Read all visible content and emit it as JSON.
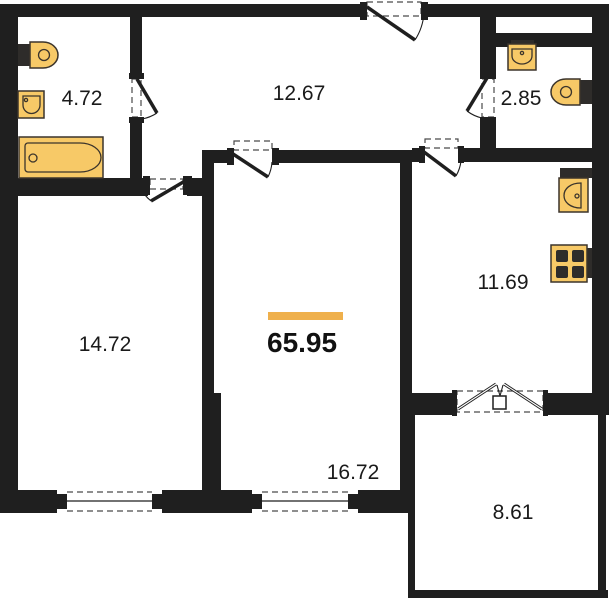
{
  "plan": {
    "total": {
      "area": "65.95"
    },
    "rooms": {
      "bathroom": {
        "area": "4.72"
      },
      "hallway": {
        "area": "12.67"
      },
      "wc": {
        "area": "2.85"
      },
      "kitchen": {
        "area": "11.69"
      },
      "room1": {
        "area": "14.72"
      },
      "room2": {
        "area": "16.72"
      },
      "balcony": {
        "area": "8.61"
      }
    },
    "colors": {
      "wall": "#1f1f1f",
      "fixture_fill": "#f7c967",
      "fixture_stroke": "#3b342b",
      "accent": "#efb04c",
      "background": "#ffffff"
    }
  }
}
